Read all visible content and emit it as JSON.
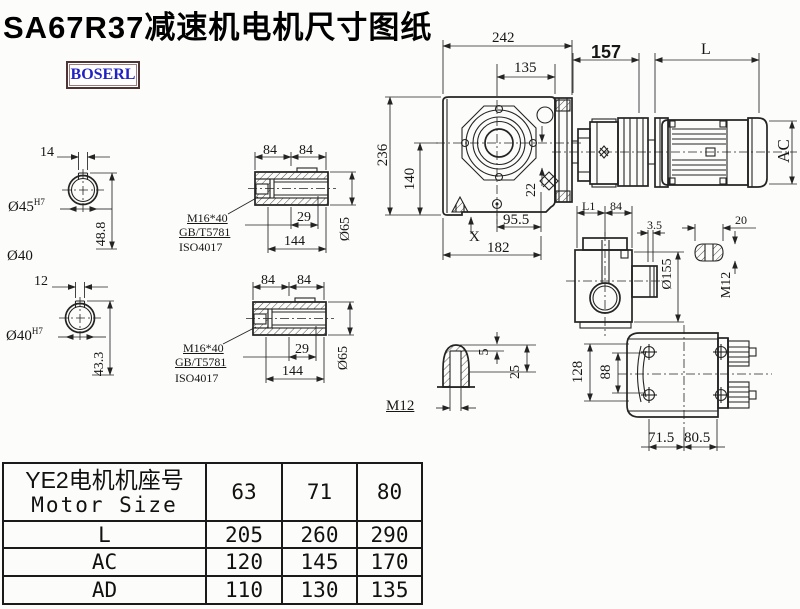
{
  "title": "SA67R37减速机电机尺寸图纸",
  "logo": {
    "text": "BOSERL"
  },
  "colors": {
    "line": "#242424",
    "logo_text": "#2222c4",
    "logo_border": "#4e3434"
  },
  "shaft_upper": {
    "key_width": "14",
    "bore_dia": "Ø45",
    "bore_tol": "H7",
    "key_depth": "48.8",
    "shaft_dia": "Ø40"
  },
  "shaft_lower": {
    "key_width": "12",
    "bore_dia": "Ø40",
    "bore_tol": "H7",
    "key_depth": "43.3"
  },
  "bushing_upper": {
    "len_a": "84",
    "len_b": "84",
    "bolt_spec": "M16*40",
    "standard_1": "GB/T5781",
    "standard_2": "ISO4017",
    "thread_depth": "29",
    "total_length": "144",
    "outer_dia": "Ø65"
  },
  "bushing_lower": {
    "len_a": "84",
    "len_b": "84",
    "bolt_spec": "M16*40",
    "standard_1": "GB/T5781",
    "standard_2": "ISO4017",
    "thread_depth": "29",
    "total_length": "144",
    "outer_dia": "Ø65"
  },
  "front_view": {
    "overall_width": "242",
    "center_to_right": "135",
    "overall_height": "236",
    "center_to_bottom": "140",
    "plug_offset": "22",
    "bolt_to_center": "95.5",
    "x_mark": "X",
    "base_width": "182"
  },
  "side_view": {
    "gearbox_length": "157",
    "motor_length_label": "L",
    "motor_dia_label": "AC"
  },
  "output_view": {
    "l1_label": "L1",
    "hub_width": "84",
    "flange_thickness": "3.5",
    "key_width": "20",
    "flange_dia": "Ø155",
    "tap_size": "M12"
  },
  "key_detail": {
    "key_height": "5",
    "key_depth": "25",
    "tap_size": "M12"
  },
  "top_view": {
    "housing_width": "128",
    "bore_span": "88",
    "foot_left": "71.5",
    "foot_right": "80.5"
  },
  "spec_table": {
    "header_cn": "YE2电机机座号",
    "header_en": "Motor Size",
    "motor_sizes": [
      "63",
      "71",
      "80"
    ],
    "rows": [
      {
        "label": "L",
        "values": [
          "205",
          "260",
          "290"
        ]
      },
      {
        "label": "AC",
        "values": [
          "120",
          "145",
          "170"
        ]
      },
      {
        "label": "AD",
        "values": [
          "110",
          "130",
          "135"
        ]
      }
    ]
  }
}
